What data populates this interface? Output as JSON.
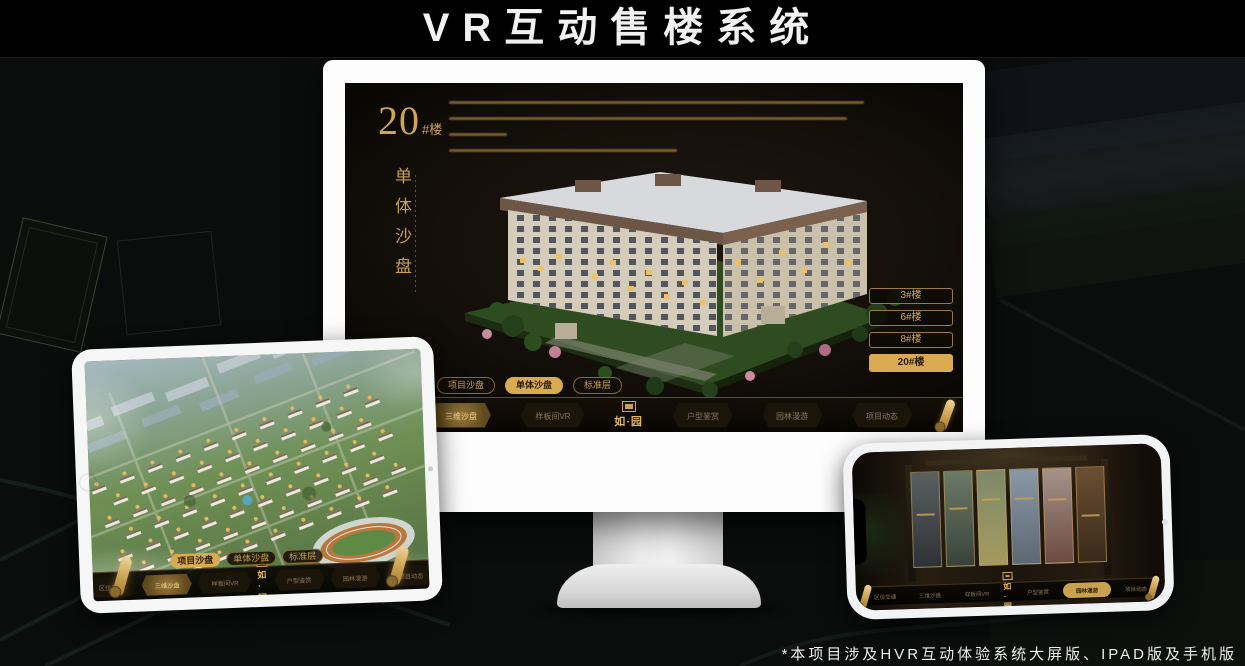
{
  "title": "VR互动售楼系统",
  "footnote": "*本项目涉及HVR互动体验系统大屏版、IPAD版及手机版",
  "brand": {
    "logo_text": "如·园"
  },
  "colors": {
    "gold": "#c9a050",
    "gold_active": "#d9aa4f",
    "screen_bg": "#15100a",
    "title_color": "#f2f2f2"
  },
  "mode_tabs": [
    {
      "label": "项目沙盘"
    },
    {
      "label": "单体沙盘"
    },
    {
      "label": "标准层"
    }
  ],
  "nav_items": [
    {
      "label": "区位交通"
    },
    {
      "label": "三维沙盘"
    },
    {
      "label": "样板间VR"
    },
    {
      "label": "户型鉴赏"
    },
    {
      "label": "园林漫游"
    },
    {
      "label": "项目动态"
    }
  ],
  "monitor": {
    "block_number": "20",
    "block_suffix": "#楼",
    "block_subtitle": "单体沙盘",
    "floor_buttons": [
      {
        "label": "3#楼"
      },
      {
        "label": "6#楼"
      },
      {
        "label": "8#楼"
      },
      {
        "label": "20#楼"
      }
    ],
    "active_floor": "20#楼",
    "active_mode_tab": "单体沙盘",
    "active_nav": "三维沙盘"
  },
  "tablet": {
    "active_mode_tab": "项目沙盘",
    "active_nav": "三维沙盘"
  },
  "phone": {
    "active_nav": "园林漫游"
  }
}
